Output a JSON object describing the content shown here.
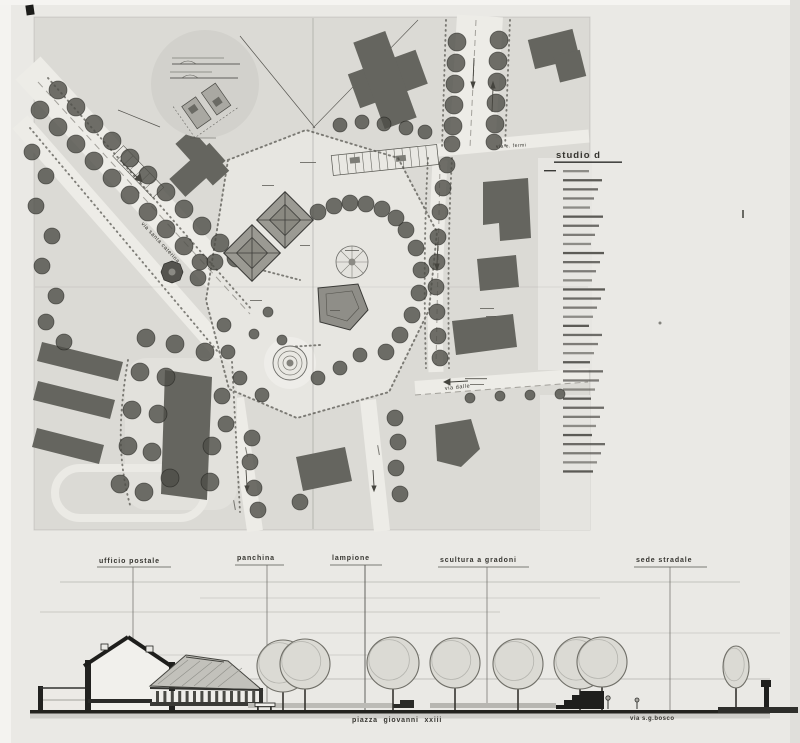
{
  "colors": {
    "paper": "#eae9e5",
    "plan_paper": "#dbdad5",
    "street": "#edece7",
    "building": "#65655f",
    "tree": "#4e4d47",
    "ink": "#2f2f2c",
    "ground": "#23231f"
  },
  "plan": {
    "street_labels": [
      {
        "id": "via-santa-caterina",
        "text": "via santa caterina"
      },
      {
        "id": "via-e-fermi",
        "text": "via e. fermi"
      },
      {
        "id": "via-dalle",
        "text": "via dalle"
      }
    ],
    "legend": {
      "title": "studio d",
      "line_count": 34
    },
    "trees": [
      [
        58,
        90,
        9
      ],
      [
        76,
        107,
        9
      ],
      [
        94,
        124,
        9
      ],
      [
        112,
        141,
        9
      ],
      [
        130,
        158,
        9
      ],
      [
        148,
        175,
        9
      ],
      [
        166,
        192,
        9
      ],
      [
        184,
        209,
        9
      ],
      [
        202,
        226,
        9
      ],
      [
        220,
        243,
        9
      ],
      [
        236,
        258,
        9
      ],
      [
        40,
        110,
        9
      ],
      [
        58,
        127,
        9
      ],
      [
        76,
        144,
        9
      ],
      [
        94,
        161,
        9
      ],
      [
        112,
        178,
        9
      ],
      [
        130,
        195,
        9
      ],
      [
        148,
        212,
        9
      ],
      [
        166,
        229,
        9
      ],
      [
        184,
        246,
        9
      ],
      [
        200,
        262,
        8
      ],
      [
        32,
        152,
        8
      ],
      [
        46,
        176,
        8
      ],
      [
        36,
        206,
        8
      ],
      [
        52,
        236,
        8
      ],
      [
        42,
        266,
        8
      ],
      [
        56,
        296,
        8
      ],
      [
        46,
        322,
        8
      ],
      [
        64,
        342,
        8
      ],
      [
        457,
        42,
        9
      ],
      [
        456,
        63,
        9
      ],
      [
        455,
        84,
        9
      ],
      [
        454,
        105,
        9
      ],
      [
        453,
        126,
        9
      ],
      [
        452,
        144,
        8
      ],
      [
        499,
        40,
        9
      ],
      [
        498,
        61,
        9
      ],
      [
        497,
        82,
        9
      ],
      [
        496,
        103,
        9
      ],
      [
        495,
        124,
        9
      ],
      [
        494,
        142,
        8
      ],
      [
        340,
        125,
        7
      ],
      [
        362,
        122,
        7
      ],
      [
        384,
        124,
        7
      ],
      [
        406,
        128,
        7
      ],
      [
        425,
        132,
        7
      ],
      [
        447,
        165,
        8
      ],
      [
        443,
        188,
        8
      ],
      [
        440,
        212,
        8
      ],
      [
        438,
        237,
        8
      ],
      [
        437,
        262,
        8
      ],
      [
        436,
        287,
        8
      ],
      [
        437,
        312,
        8
      ],
      [
        438,
        336,
        8
      ],
      [
        440,
        358,
        8
      ],
      [
        318,
        212,
        8
      ],
      [
        334,
        206,
        8
      ],
      [
        350,
        203,
        8
      ],
      [
        366,
        204,
        8
      ],
      [
        382,
        209,
        8
      ],
      [
        396,
        218,
        8
      ],
      [
        406,
        230,
        8
      ],
      [
        416,
        248,
        8
      ],
      [
        421,
        270,
        8
      ],
      [
        419,
        293,
        8
      ],
      [
        412,
        315,
        8
      ],
      [
        400,
        335,
        8
      ],
      [
        386,
        352,
        8
      ],
      [
        360,
        355,
        7
      ],
      [
        340,
        368,
        7
      ],
      [
        318,
        378,
        7
      ],
      [
        262,
        395,
        7
      ],
      [
        240,
        378,
        7
      ],
      [
        228,
        352,
        7
      ],
      [
        224,
        325,
        7
      ],
      [
        215,
        262,
        8
      ],
      [
        198,
        278,
        8
      ],
      [
        140,
        372,
        9
      ],
      [
        166,
        377,
        9
      ],
      [
        132,
        410,
        9
      ],
      [
        158,
        414,
        9
      ],
      [
        128,
        446,
        9
      ],
      [
        152,
        452,
        9
      ],
      [
        120,
        484,
        9
      ],
      [
        144,
        492,
        9
      ],
      [
        170,
        478,
        9
      ],
      [
        205,
        352,
        9
      ],
      [
        175,
        344,
        9
      ],
      [
        146,
        338,
        9
      ],
      [
        212,
        446,
        9
      ],
      [
        210,
        482,
        9
      ],
      [
        226,
        424,
        8
      ],
      [
        222,
        396,
        8
      ],
      [
        252,
        438,
        8
      ],
      [
        250,
        462,
        8
      ],
      [
        254,
        488,
        8
      ],
      [
        258,
        510,
        8
      ],
      [
        300,
        502,
        8
      ],
      [
        395,
        418,
        8
      ],
      [
        398,
        442,
        8
      ],
      [
        396,
        468,
        8
      ],
      [
        400,
        494,
        8
      ],
      [
        268,
        312,
        5
      ],
      [
        254,
        334,
        5
      ],
      [
        282,
        340,
        5
      ],
      [
        470,
        398,
        5
      ],
      [
        500,
        396,
        5
      ],
      [
        530,
        395,
        5
      ],
      [
        560,
        394,
        5
      ]
    ],
    "buildings": [
      {
        "rects": [
          [
            352,
            62,
            72,
            36
          ],
          [
            368,
            34,
            34,
            92
          ]
        ],
        "rot": -20,
        "ox": 385,
        "oy": 80
      },
      {
        "rects": [
          [
            531,
            34,
            46,
            30
          ],
          [
            552,
            56,
            27,
            27
          ]
        ],
        "rot": -14,
        "ox": 554,
        "oy": 50
      },
      {
        "rects": [
          [
            172,
            158,
            54,
            24
          ],
          [
            200,
            136,
            22,
            56
          ]
        ],
        "rot": -42,
        "ox": 198,
        "oy": 172
      },
      {
        "poly": "483,182 528,178 531,238 500,241 499,223 483,225"
      },
      {
        "poly": "477,259 516,255 519,287 480,291"
      },
      {
        "poly": "452,321 513,314 517,347 456,355"
      },
      {
        "poly": "435,425 471,419 480,449 461,467 437,461"
      },
      {
        "poly": "296,457 345,447 352,481 303,491"
      },
      {
        "poly": "42,342 123,362 118,381 37,361"
      },
      {
        "poly": "38,381 115,400 110,419 33,400"
      },
      {
        "poly": "37,428 104,445 99,464 32,447"
      },
      {
        "poly": "165,370 212,377 207,500 161,494"
      }
    ]
  },
  "elevation": {
    "callouts": [
      {
        "label": "ufficio postale",
        "x": 133
      },
      {
        "label": "panchina",
        "x": 267
      },
      {
        "label": "lampione",
        "x": 365
      },
      {
        "label": "scultura a gradoni",
        "x": 487
      },
      {
        "label": "sede stradale",
        "x": 670
      }
    ],
    "street_names": [
      {
        "id": "piazza-giovanni-xxiii",
        "text": "piazza giovanni xxiii"
      },
      {
        "id": "via-sg-bosco",
        "text": "via s.g.bosco"
      }
    ],
    "colonnade_columns": 14,
    "trees": [
      [
        283,
        666,
        26
      ],
      [
        305,
        664,
        25
      ],
      [
        393,
        663,
        26
      ],
      [
        455,
        663,
        25
      ],
      [
        518,
        664,
        25
      ],
      [
        580,
        663,
        26
      ],
      [
        602,
        662,
        25
      ],
      [
        736,
        667,
        13,
        21
      ]
    ]
  }
}
